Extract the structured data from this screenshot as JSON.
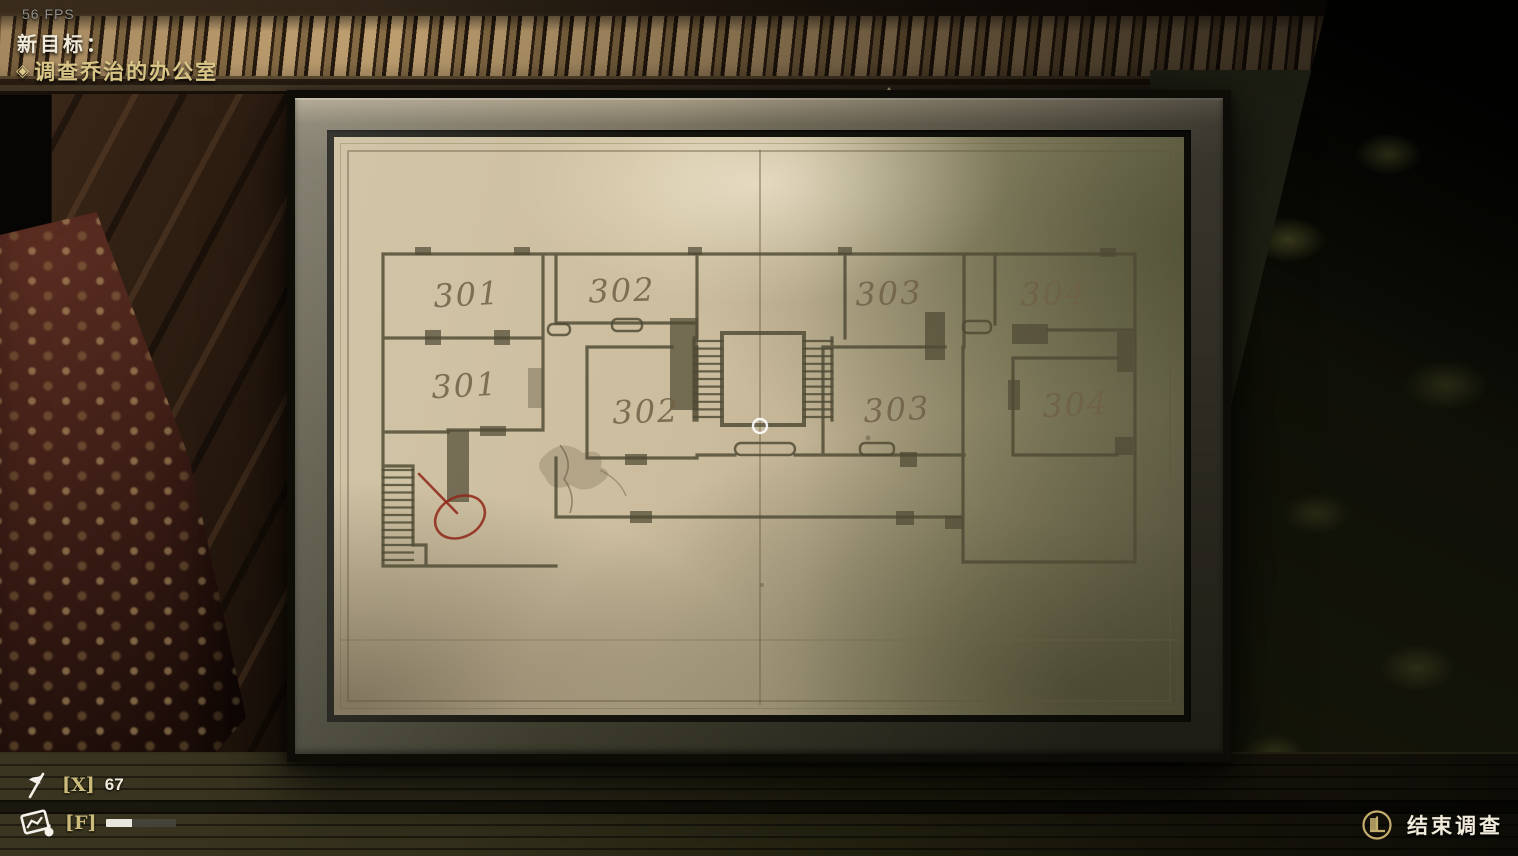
{
  "hud": {
    "fps_counter": "56 FPS",
    "objective_panel": {
      "title": "新目标：",
      "bullet": "◈",
      "objective": "调查乔治的办公室"
    },
    "inventory_bar": {
      "marker_slot": {
        "key_hint": "[X]",
        "count": "67"
      },
      "camera_slot": {
        "key_hint": "[F]",
        "progress_percent": 37
      }
    },
    "action_prompt": {
      "label": "结束调查"
    }
  },
  "map": {
    "room_labels": [
      "301",
      "301",
      "302",
      "302",
      "303",
      "303",
      "304",
      "304"
    ]
  },
  "colors": {
    "objective_gold": "#d9c687",
    "hud_white": "#f1ebdb",
    "fps_gray": "#8f8e8a",
    "hud_key_gold": "#cdbb7c",
    "annotation_red": "#8f2718",
    "plan_ink": "#4e4933",
    "paper_base": "#cbbc9d",
    "prompt_icon_gold": "#c3ad6d"
  }
}
